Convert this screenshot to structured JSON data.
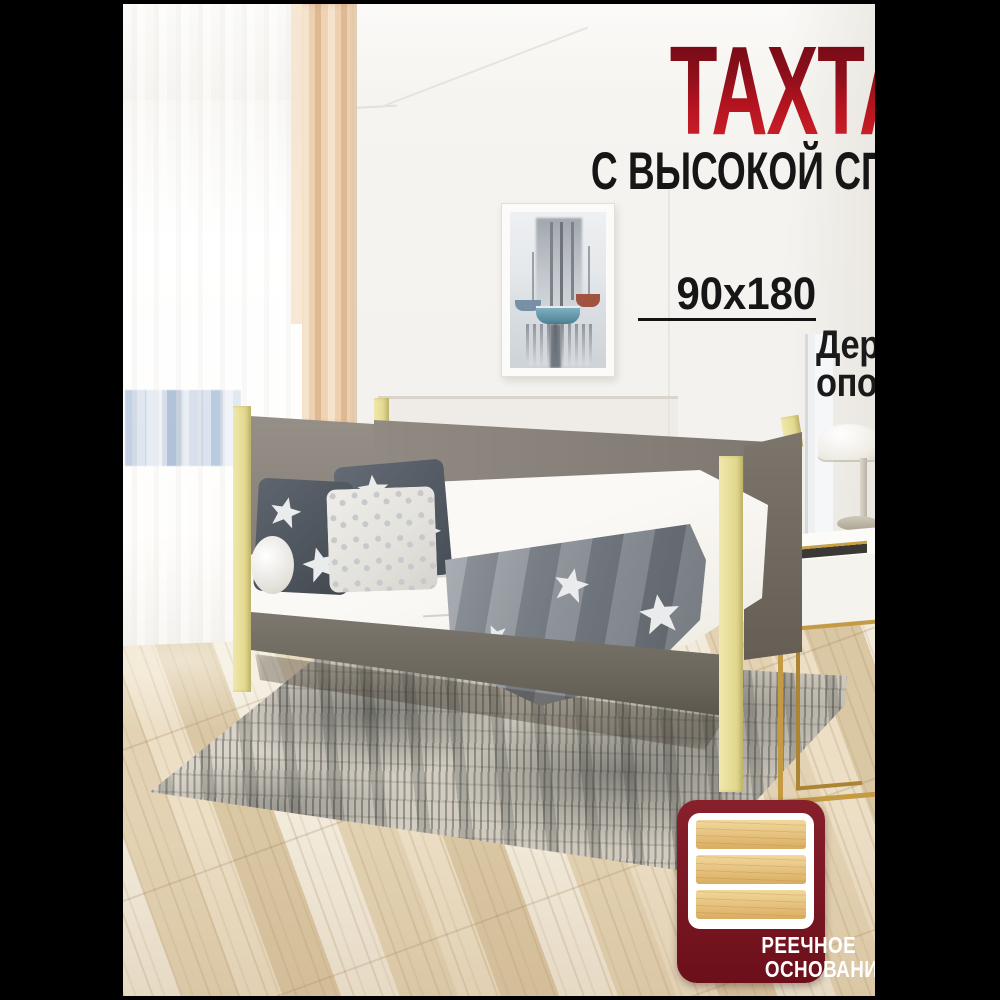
{
  "title": {
    "main": "ТАХТА МЯГКАЯ",
    "subtitle": "С ВЫСОКОЙ СПИНКОЙ"
  },
  "specs": {
    "size": "90x180",
    "feature_line1": "Деревянные",
    "feature_line2": "опоры"
  },
  "badge": {
    "line1": "РЕЕЧНОЕ",
    "line2": "ОСНОВАНИЕ",
    "icon": "wood-slats-icon"
  },
  "colors": {
    "title_red_top": "#6a0a13",
    "title_red_bottom": "#d4252e",
    "text_black": "#161616",
    "badge_maroon": "#7a1420",
    "bed_gray": "#8b857c",
    "post_yellow": "#ece3a2",
    "gold": "#c49a43",
    "pillarbox_black": "#000000"
  }
}
